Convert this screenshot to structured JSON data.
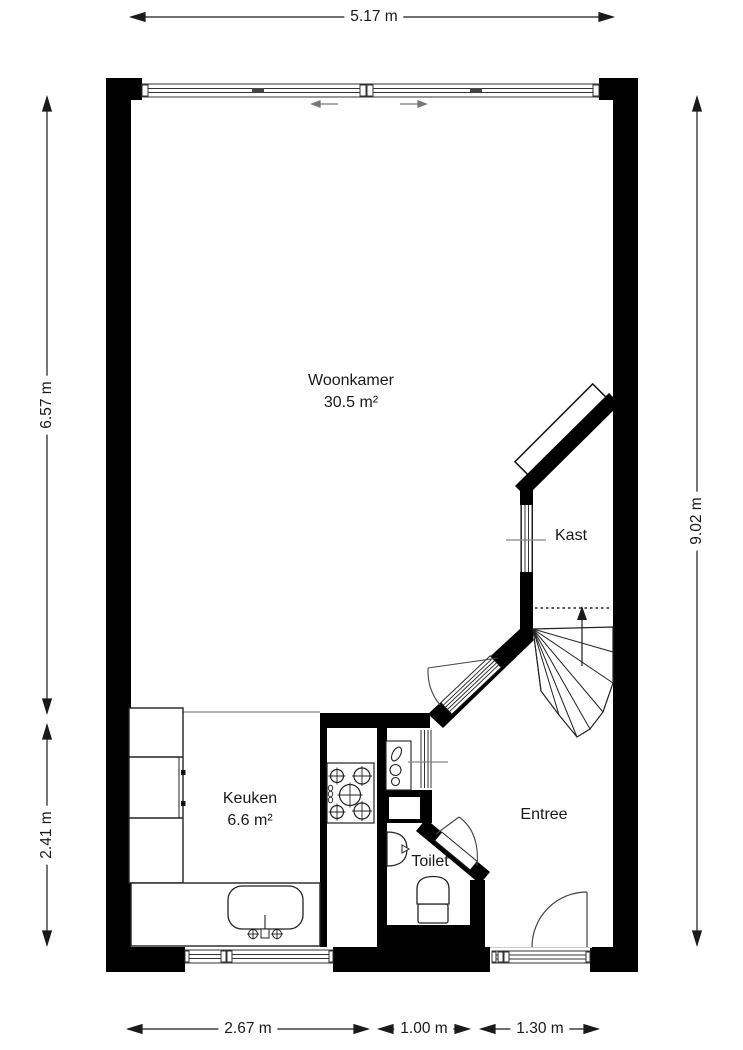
{
  "floorplan": {
    "rooms": [
      {
        "name": "Woonkamer",
        "area": "30.5 m²"
      },
      {
        "name": "Kast",
        "area": ""
      },
      {
        "name": "Keuken",
        "area": "6.6 m²"
      },
      {
        "name": "Toilet",
        "area": ""
      },
      {
        "name": "Entree",
        "area": ""
      }
    ],
    "dimensions": {
      "top": "5.17 m",
      "left_upper": "6.57 m",
      "left_lower": "2.41 m",
      "right": "9.02 m",
      "bottom_left": "2.67 m",
      "bottom_middle": "1.00 m",
      "bottom_right": "1.30 m"
    },
    "icons": [
      "stairs-icon",
      "stair-direction-arrow-icon",
      "stove-icon",
      "kitchen-sink-icon",
      "toilet-icon",
      "washbasin-icon",
      "door-swing-icon",
      "sliding-window-arrow-icon"
    ],
    "colors": {
      "wall": "#000000",
      "line": "#1a1a1a",
      "background": "#ffffff",
      "accent_gray": "#808080"
    }
  }
}
